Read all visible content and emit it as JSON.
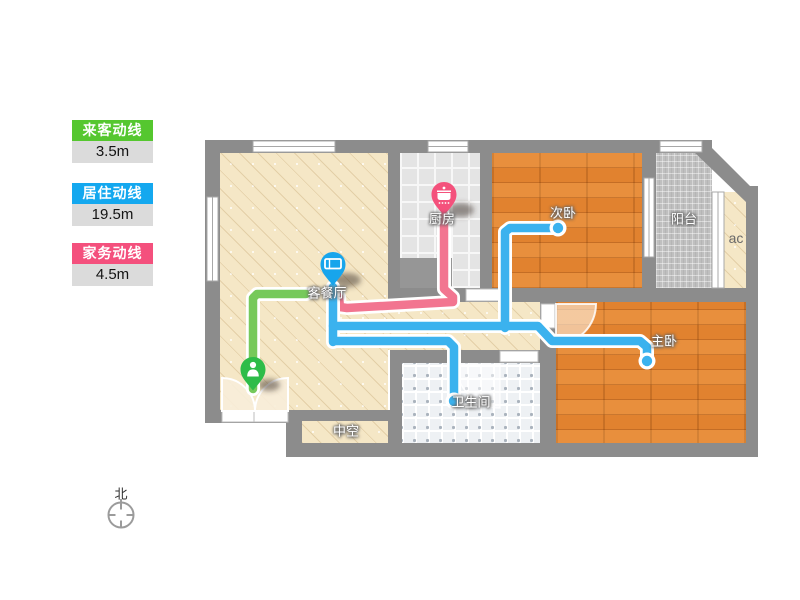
{
  "legend": {
    "items": [
      {
        "label": "来客动线",
        "value": "3.5m",
        "color": "#55c72f"
      },
      {
        "label": "居住动线",
        "value": "19.5m",
        "color": "#14a8ef"
      },
      {
        "label": "家务动线",
        "value": "4.5m",
        "color": "#f4507d"
      }
    ]
  },
  "rooms": {
    "living": "客餐厅",
    "kitchen": "厨房",
    "secondary_bedroom": "次卧",
    "master_bedroom": "主卧",
    "bathroom": "卫生间",
    "balcony": "阳台",
    "ac": "ac",
    "void": "中空"
  },
  "compass": {
    "north_label": "北"
  },
  "pins": [
    {
      "room": "living",
      "icon": "bed-icon",
      "color": "#17a5ec"
    },
    {
      "room": "kitchen",
      "icon": "pot-icon",
      "color": "#f4517c"
    },
    {
      "room": "entrance",
      "icon": "person-icon",
      "color": "#2ebc49"
    }
  ],
  "routes": [
    {
      "id": "visitor",
      "label": "来客动线",
      "length": "3.5m",
      "line_color": "#76c95b",
      "segments": [
        [
          [
            253,
            389
          ],
          [
            253,
            298
          ],
          [
            257,
            294
          ],
          [
            306,
            294
          ]
        ]
      ],
      "dots": []
    },
    {
      "id": "housework",
      "label": "家务动线",
      "length": "4.5m",
      "line_color": "#f27590",
      "segments": [
        [
          [
            444,
            216
          ],
          [
            444,
            289
          ],
          [
            453,
            297
          ],
          [
            453,
            302
          ],
          [
            347,
            308
          ],
          [
            340,
            307
          ],
          [
            339,
            297
          ]
        ]
      ],
      "dots": []
    },
    {
      "id": "resident",
      "label": "居住动线",
      "length": "19.5m",
      "line_color": "#3bb2ee",
      "segments": [
        [
          [
            333,
            287
          ],
          [
            333,
            342
          ]
        ],
        [
          [
            333,
            326
          ],
          [
            538,
            326
          ],
          [
            552,
            341
          ],
          [
            640,
            341
          ],
          [
            647,
            347
          ],
          [
            647,
            360
          ]
        ],
        [
          [
            505,
            328
          ],
          [
            505,
            232
          ],
          [
            510,
            228
          ],
          [
            556,
            228
          ]
        ],
        [
          [
            334,
            341
          ],
          [
            448,
            341
          ],
          [
            454,
            347
          ],
          [
            454,
            399
          ]
        ]
      ],
      "dots": [
        [
          558,
          228
        ],
        [
          647,
          361
        ],
        [
          454,
          401
        ]
      ]
    }
  ]
}
